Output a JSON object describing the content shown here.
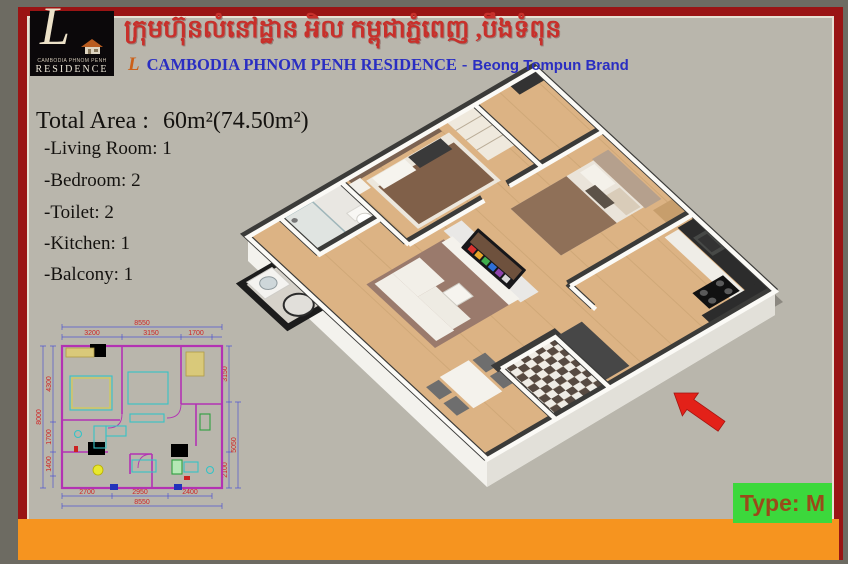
{
  "poster": {
    "colors": {
      "margin_grey": "#6d6b62",
      "background_beige": "#b9b6ac",
      "border_red": "#9a1414",
      "bottom_bar_orange": "#f6941f",
      "badge_green": "#3cd83c",
      "badge_text_brown": "#9a4a1a",
      "khmer_red": "#c8302b",
      "subtitle_blue": "#2a2ec2",
      "dim_text_red": "#cf2424",
      "dim_line_blue": "#5055cf",
      "wall_magenta": "#b332b3",
      "furniture_cyan": "#35c3c6",
      "arrow_red": "#e32119",
      "wood_floor": "#dcb384"
    },
    "header": {
      "logo_monogram": "L",
      "logo_line1": "CAMBODIA PHNOM PENH",
      "logo_line2": "RESIDENCE",
      "khmer_title": "ក្រុមហ៊ុនលំនៅដ្ឋាន អិល កម្ពុជាភ្នំពេញ ,បឹងទំពុន",
      "subtitle_monogram": "L",
      "subtitle_name": "CAMBODIA PHNOM PENH RESIDENCE",
      "subtitle_separator": "-",
      "subtitle_brand": "Beong Tompun Brand"
    },
    "summary": {
      "total_area_label": "Total Area :",
      "total_area_value": "60m²(74.50m²)",
      "features": [
        "-Living Room: 1",
        "-Bedroom: 2",
        "-Toilet: 2",
        "-Kitchen: 1",
        "-Balcony: 1"
      ]
    },
    "type_badge": "Type: M",
    "plan2d": {
      "top": {
        "overall": "8550",
        "segments": [
          "3200",
          "3150",
          "1700"
        ]
      },
      "left": {
        "overall": "8000",
        "segments": [
          "4300",
          "1700",
          "1400"
        ]
      },
      "right": {
        "overall": "5050",
        "segments": [
          "3150",
          "2100"
        ]
      },
      "bottom": {
        "overall": "8550",
        "segments": [
          "2700",
          "2950",
          "2400"
        ]
      }
    }
  }
}
